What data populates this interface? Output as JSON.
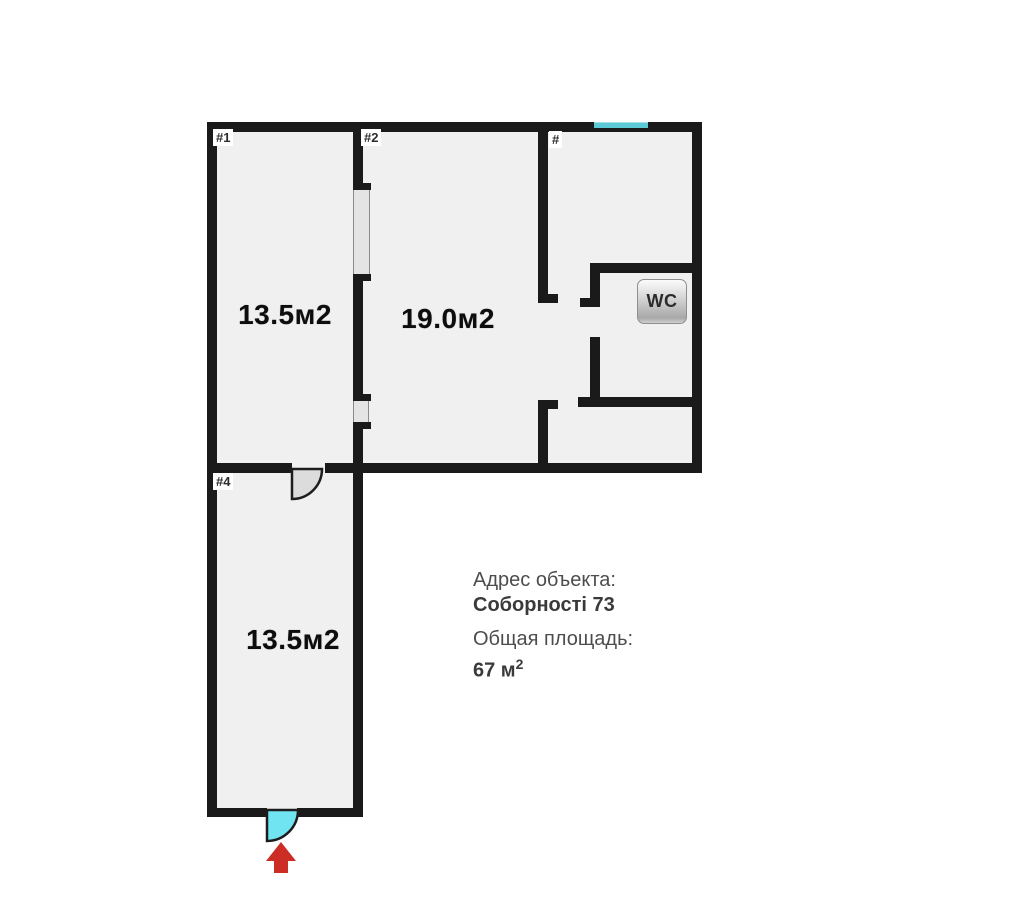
{
  "floorplan": {
    "room1": {
      "tag": "#1",
      "area": "13.5м2"
    },
    "room2": {
      "tag": "#2",
      "area": "19.0м2"
    },
    "hall": {
      "tag": "#"
    },
    "room4": {
      "tag": "#4",
      "area": "13.5м2"
    },
    "wc_badge": "WC"
  },
  "info": {
    "address_label": "Адрес объекта:",
    "address_value": "Соборності 73",
    "total_area_label": "Общая площадь:",
    "total_area_value": "67 м",
    "total_area_superscript": "2"
  },
  "colors": {
    "wall": "#1a1a1a",
    "room_fill": "#f0f0f0",
    "door_swing": "#dcdcdc",
    "entrance_door": "#70e4f1",
    "window_marker": "#5bcad5",
    "entrance_arrow": "#cc2e26"
  }
}
